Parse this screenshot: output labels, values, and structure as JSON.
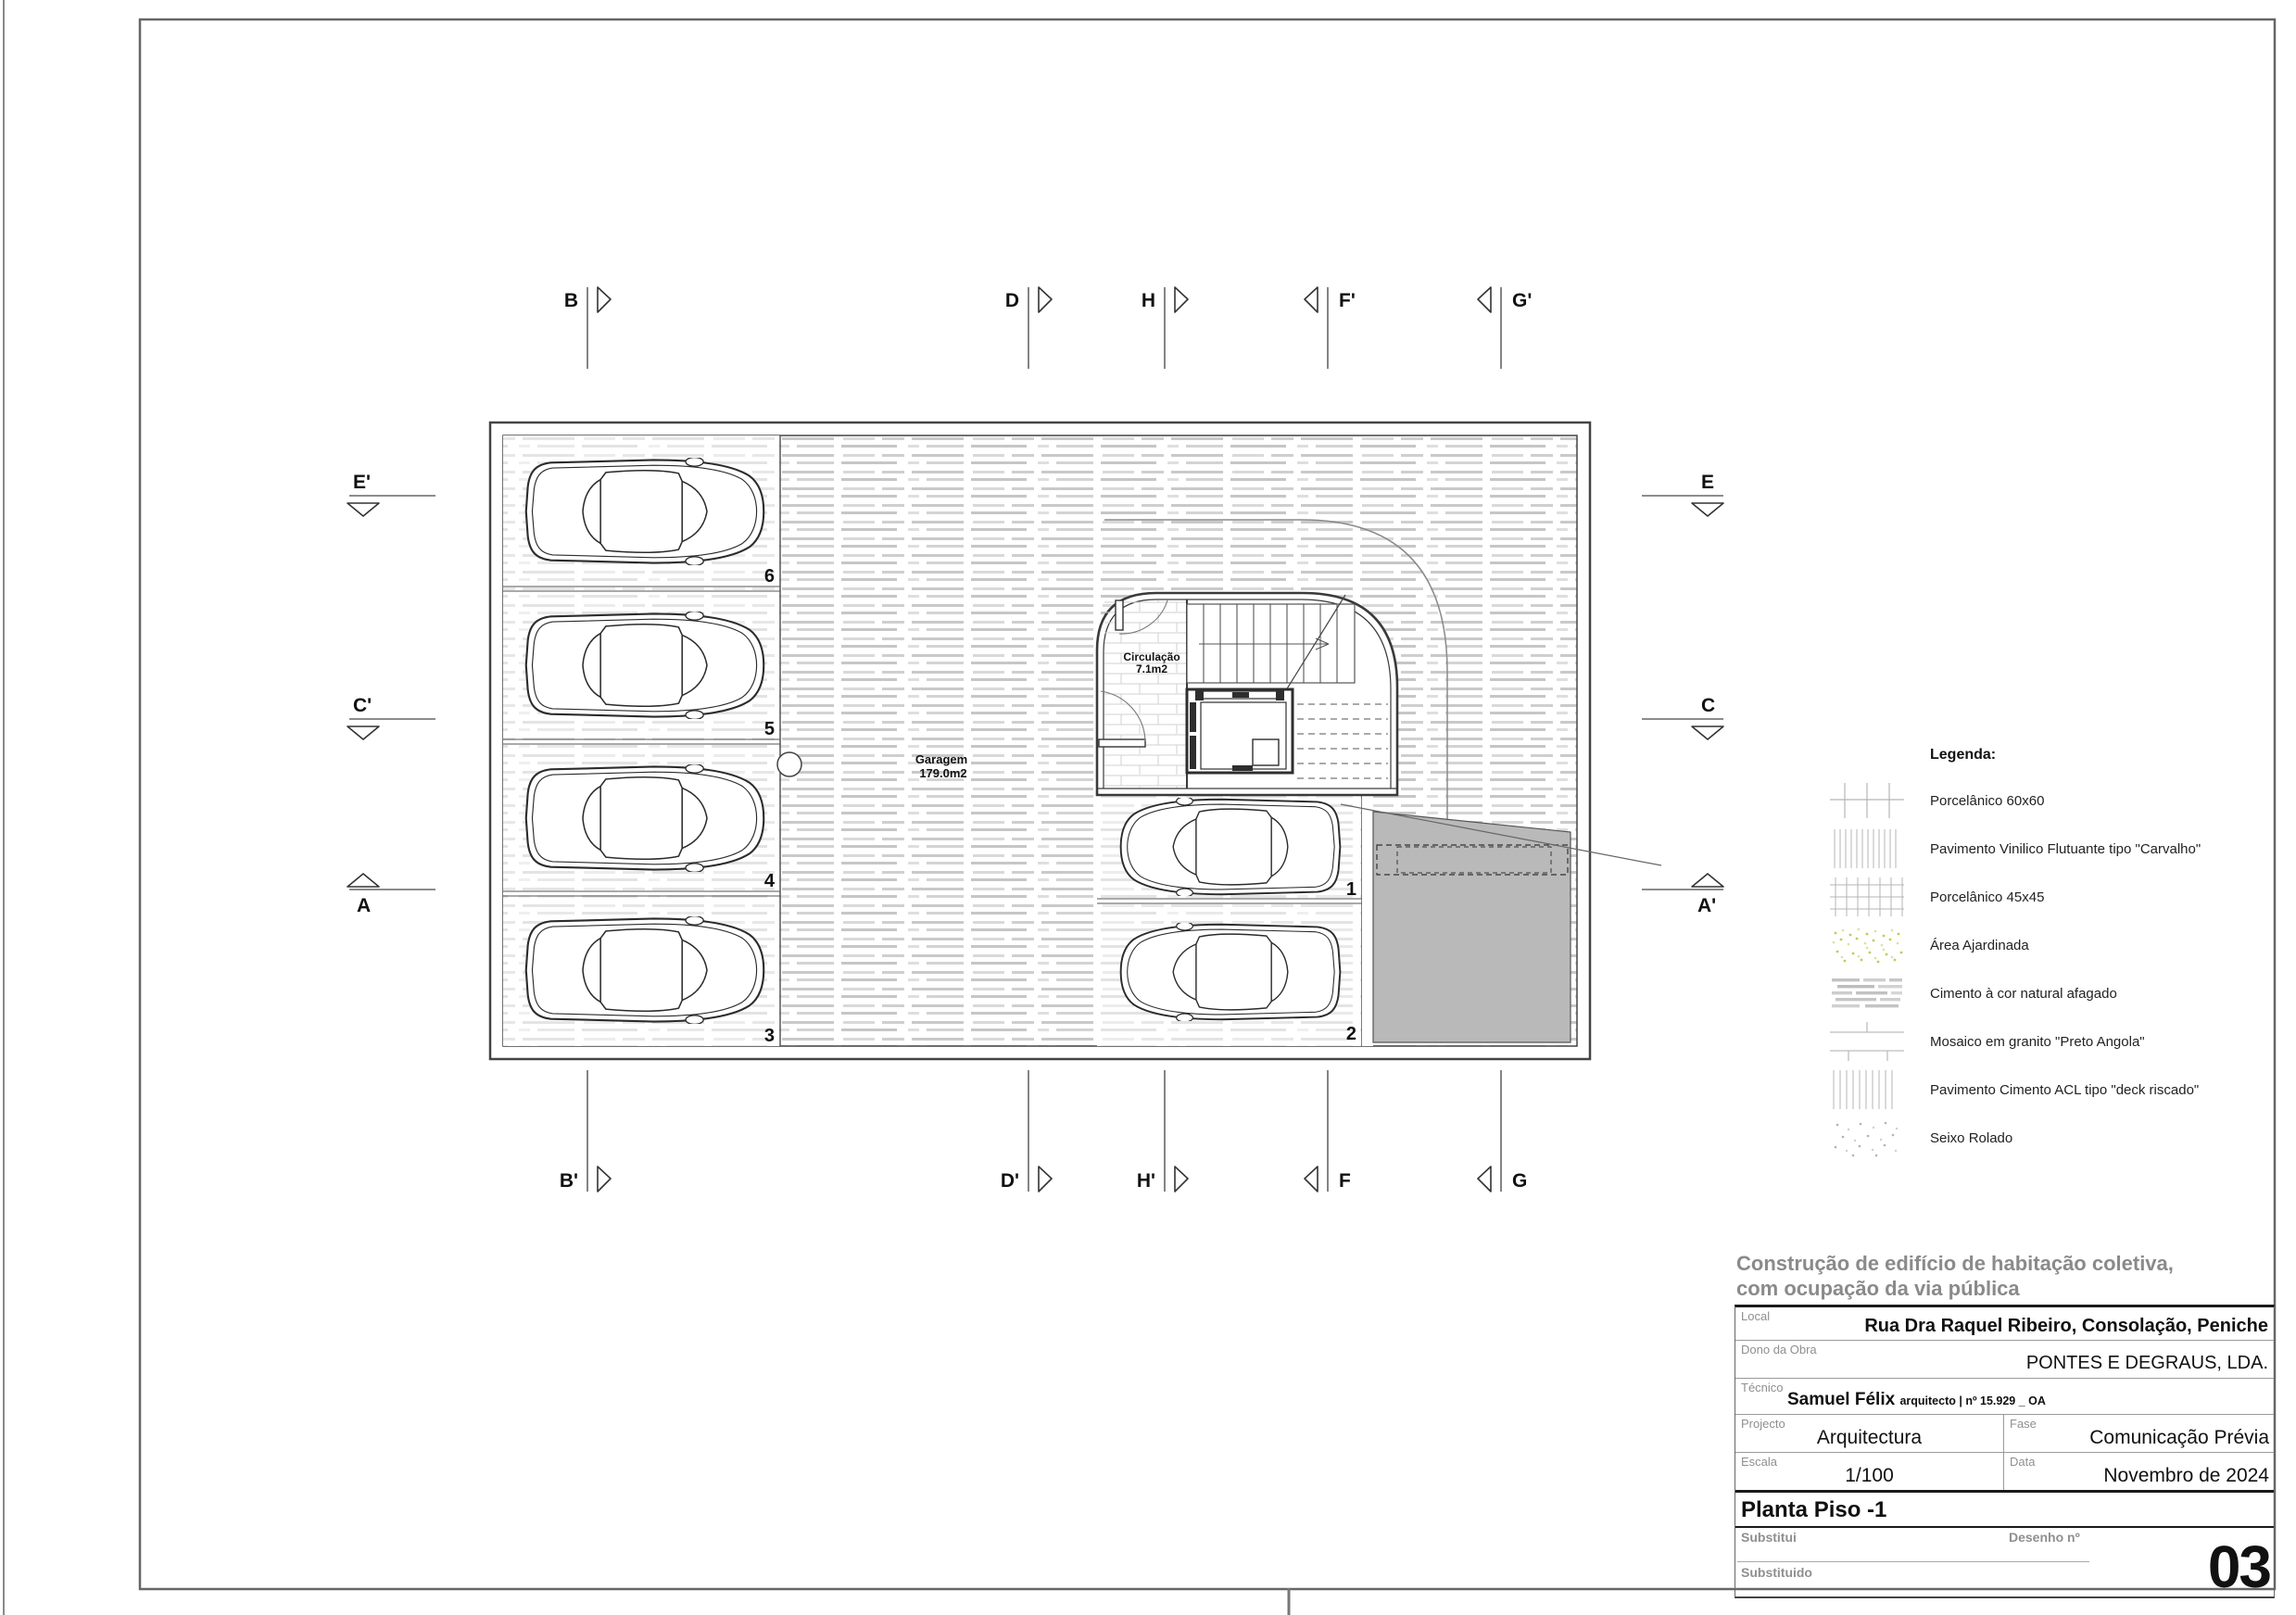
{
  "plan": {
    "garagem_line1": "Garagem",
    "garagem_line2": "179.0m2",
    "circulacao_line1": "Circulação",
    "circulacao_line2": "7.1m2",
    "stalls": [
      "6",
      "5",
      "4",
      "3",
      "1",
      "2"
    ]
  },
  "markers": {
    "top": [
      "B",
      "D",
      "H",
      "F'",
      "G'"
    ],
    "bottom": [
      "B'",
      "D'",
      "H'",
      "F",
      "G"
    ],
    "left": [
      "E'",
      "C'",
      "A"
    ],
    "right": [
      "E",
      "C",
      "A'"
    ]
  },
  "legend": {
    "title": "Legenda:",
    "items": [
      "Porcelânico 60x60",
      "Pavimento Vinilico Flutuante tipo \"Carvalho\"",
      "Porcelânico 45x45",
      "Área Ajardinada",
      "Cimento à cor natural afagado",
      "Mosaico em granito \"Preto Angola\"",
      "Pavimento Cimento ACL tipo \"deck riscado\"",
      "Seixo Rolado"
    ],
    "colors": {
      "garden_dot": "#b9cf57",
      "hatch_gray": "#c6c6c6",
      "ramp_gray": "#b9b9b9"
    }
  },
  "title_block": {
    "project_title_line1": "Construção de edifício de habitação coletiva,",
    "project_title_line2": "com ocupação da via pública",
    "local_label": "Local",
    "local_value": "Rua Dra Raquel Ribeiro, Consolação, Peniche",
    "dono_label": "Dono da Obra",
    "dono_value": "PONTES E DEGRAUS, LDA.",
    "tecnico_label": "Técnico",
    "tecnico_value": "Samuel Félix",
    "tecnico_suffix": "arquitecto | nº 15.929 _ OA",
    "projecto_label": "Projecto",
    "projecto_value": "Arquitectura",
    "fase_label": "Fase",
    "fase_value": "Comunicação Prévia",
    "escala_label": "Escala",
    "escala_value": "1/100",
    "data_label": "Data",
    "data_value": "Novembro de 2024",
    "drawing_title": "Planta Piso -1",
    "substitui_label": "Substitui",
    "substituido_label": "Substituido",
    "desenho_label": "Desenho nº",
    "desenho_num": "03"
  }
}
